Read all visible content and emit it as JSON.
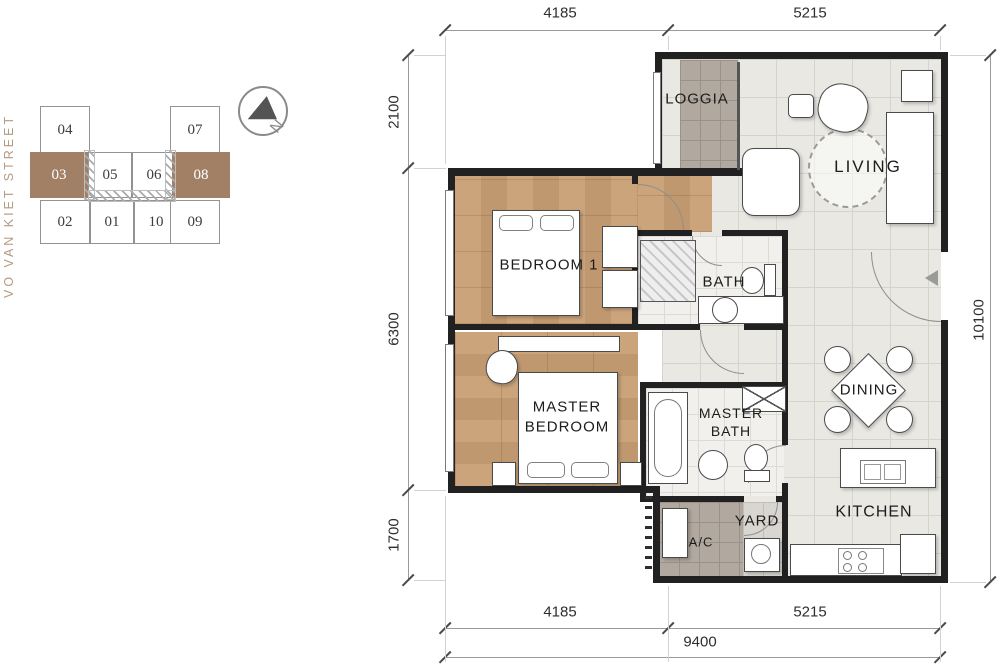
{
  "street_label": "VO VAN KIET STREET",
  "key_plan": {
    "north_label": "N",
    "units": [
      {
        "id": "04",
        "highlighted": false
      },
      {
        "id": "07",
        "highlighted": false
      },
      {
        "id": "03",
        "highlighted": true
      },
      {
        "id": "05",
        "highlighted": false
      },
      {
        "id": "06",
        "highlighted": false
      },
      {
        "id": "08",
        "highlighted": true
      },
      {
        "id": "02",
        "highlighted": false
      },
      {
        "id": "01",
        "highlighted": false
      },
      {
        "id": "10",
        "highlighted": false
      },
      {
        "id": "09",
        "highlighted": false
      }
    ]
  },
  "rooms": {
    "loggia": "LOGGIA",
    "living": "LIVING",
    "bedroom1": "BEDROOM 1",
    "bath": "BATH",
    "master_bedroom": "MASTER BEDROOM",
    "master_bath": "MASTER BATH",
    "dining": "DINING",
    "kitchen": "KITCHEN",
    "yard": "YARD",
    "ac": "A/C"
  },
  "dimensions": {
    "top": [
      "4185",
      "5215"
    ],
    "bottom": [
      "4185",
      "5215"
    ],
    "bottom_total": "9400",
    "left": [
      "2100",
      "6300",
      "1700"
    ],
    "right": "10100"
  },
  "colors": {
    "accent": "#A28066",
    "wood": "#CBA47C",
    "tile": "#E9E8E3",
    "grey": "#B1A89F",
    "wall": "#212121",
    "street": "#B49B83"
  }
}
